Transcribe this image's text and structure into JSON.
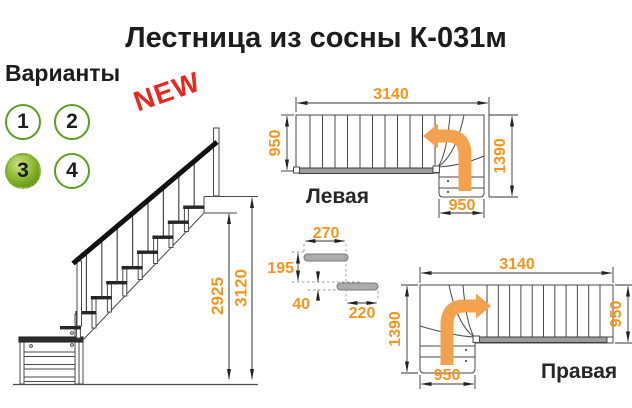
{
  "title": "Лестница из сосны К-031м",
  "variants": {
    "label": "Варианты",
    "badge": "NEW",
    "options": [
      {
        "label": "1",
        "selected": false
      },
      {
        "label": "2",
        "selected": false
      },
      {
        "label": "3",
        "selected": true
      },
      {
        "label": "4",
        "selected": false
      }
    ]
  },
  "side_view": {
    "dim_floor_height": "2925",
    "dim_total_height": "3120"
  },
  "plan_left": {
    "label": "Левая",
    "dim_length": "3140",
    "dim_width": "950",
    "dim_turn": "1390",
    "dim_landing": "950"
  },
  "plan_right": {
    "label": "Правая",
    "dim_length": "3140",
    "dim_width": "950",
    "dim_turn": "1390",
    "dim_landing": "950"
  },
  "step_detail": {
    "dim_tread_depth": "270",
    "dim_riser": "195",
    "dim_thickness": "40",
    "dim_going": "220"
  },
  "colors": {
    "dimension_orange": "#f7941d",
    "arrow_orange": "#f2a14e",
    "variant_green": "#5c9e1e",
    "badge_red": "#e6281e"
  }
}
